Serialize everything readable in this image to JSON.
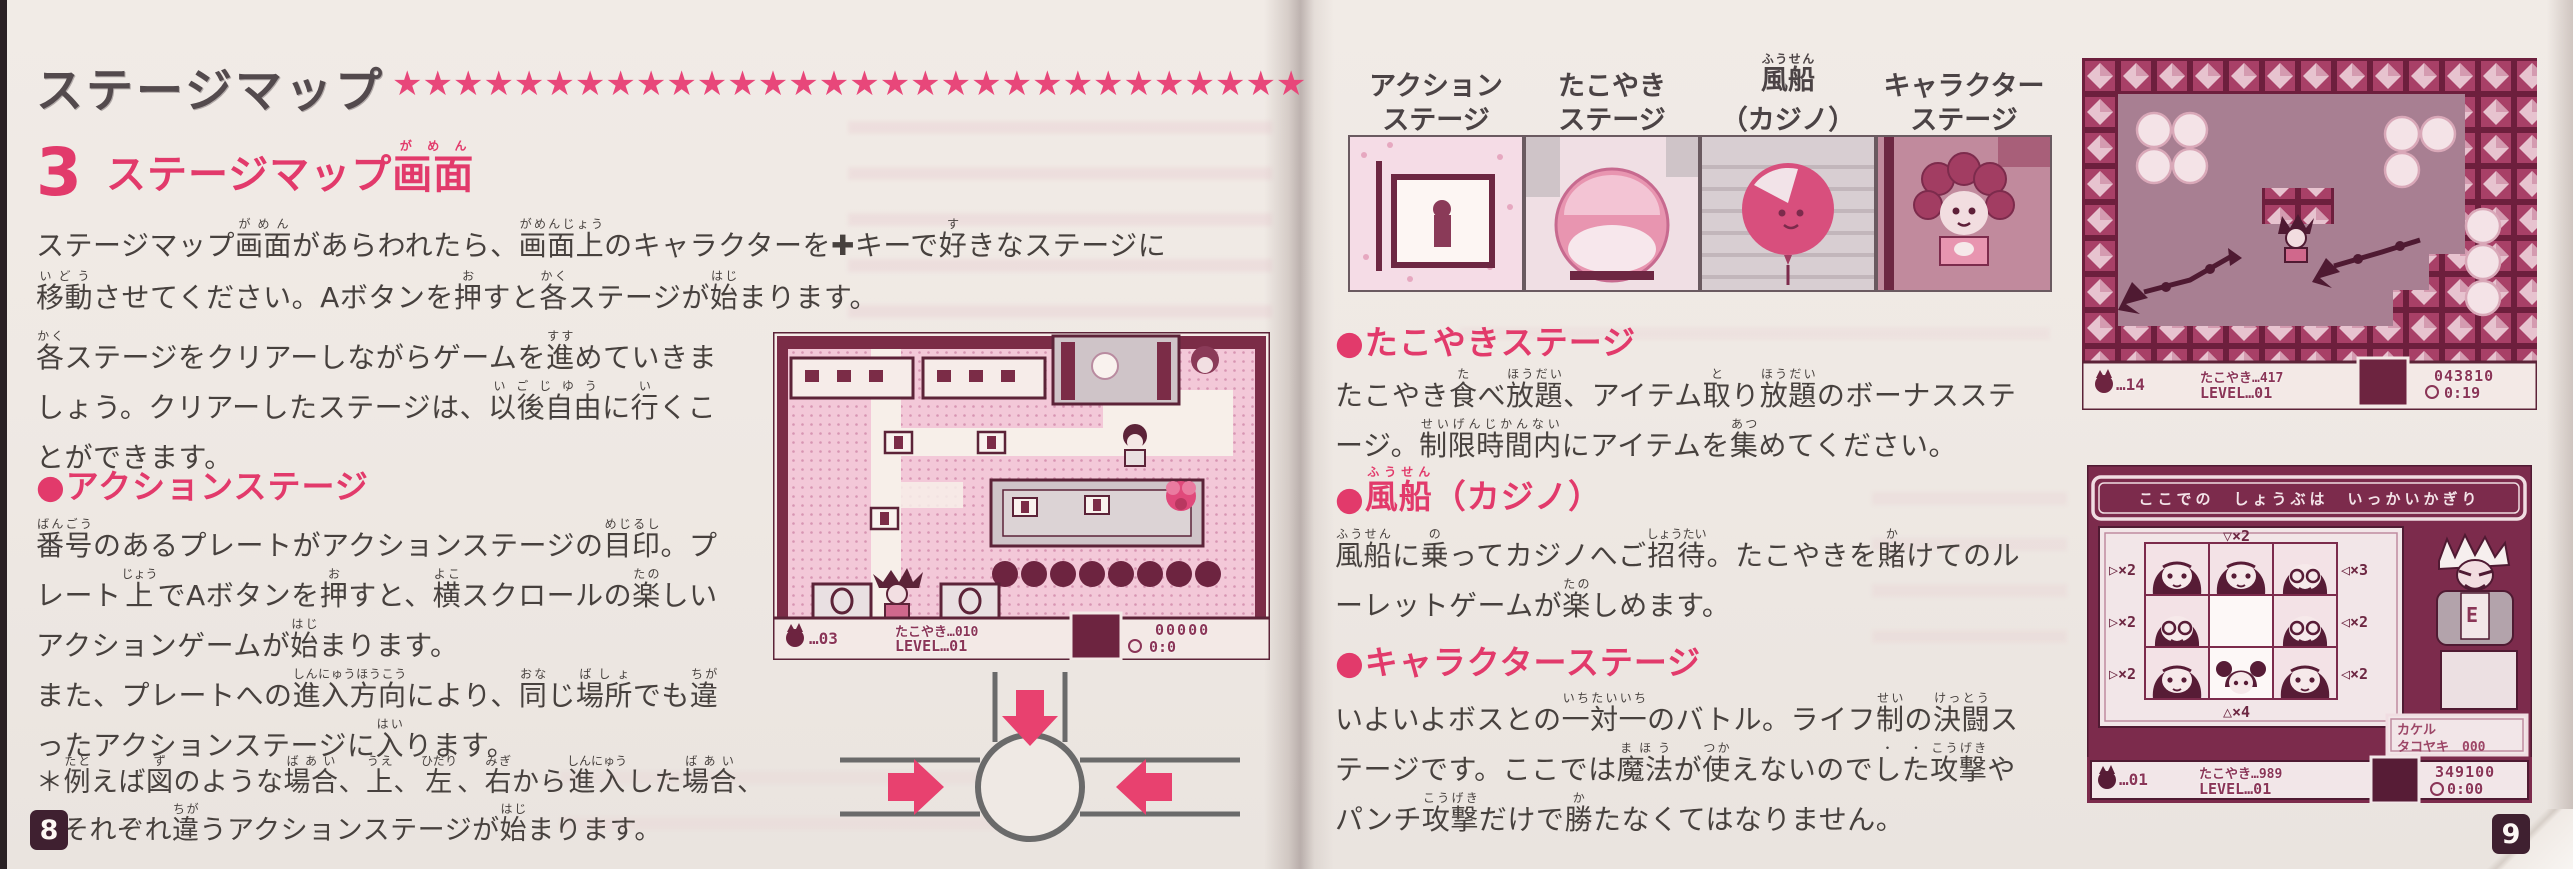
{
  "page_left": {
    "title": "ステージマップ",
    "stars": "★★★★★★★★★★★★★★★★★★★★★★★★★★★★★★",
    "section_number": "3",
    "section_heading": "ステージマップ[画面|がめん]",
    "para1": [
      "ステージマップ[画面|がめん]があらわれたら、[画面上|がめんじょう]のキャラクターを✚キーで[好|す]きなステージに",
      "[移動|いどう]させてください。Aボタンを[押|お]すと[各|かく]ステージが[始|はじ]まります。"
    ],
    "para2": [
      "[各|かく]ステージをクリアーしながらゲームを[進|すす]めていきま",
      "しょう。クリアーしたステージは、[以後自由|いごじゆう]に[行|い]くこ",
      "とができます。"
    ],
    "action_heading": "●アクションステージ",
    "para3": [
      "[番号|ばんごう]のあるプレートがアクションステージの[目印|めじるし]。プ",
      "レート[上|じょう]でAボタンを[押|お]すと、[横|よこ]スクロールの[楽|たの]しい",
      "アクションゲームが[始|はじ]まります。",
      "また、プレートへの[進入方向|しんにゅうほうこう]により、[同|おな]じ[場所|ばしょ]でも[違|ちが]",
      "ったアクションステージに[入|はい]ります。"
    ],
    "footnote": [
      "＊[例|たと]えば[図|ず]のような[場合|ばあい]、[上|うえ]、[左|ひだり]、[右|みぎ]から[進入|しんにゅう]した[場合|ばあい]、",
      "それぞれ[違|ちが]うアクションステージが[始|はじ]まります。"
    ],
    "map_hud": {
      "lives": "…03",
      "takoyaki": "たこやき…010",
      "level": "LEVEL…01",
      "score": "00000",
      "time": "0:0"
    },
    "page_number": "8"
  },
  "page_right": {
    "thumb_labels": [
      [
        "アクション",
        "ステージ"
      ],
      [
        "たこやき",
        "ステージ"
      ],
      [
        "[風船|ふうせん]",
        "（カジノ）"
      ],
      [
        "キャラクター",
        "ステージ"
      ]
    ],
    "takoyaki_heading": "●たこやきステージ",
    "takoyaki_lines": [
      "たこやき[食|た]べ[放題|ほうだい]、アイテム[取|と]り[放題|ほうだい]のボーナスステ",
      "ージ。[制限時間内|せいげんじかんない]にアイテムを[集|あつ]めてください。"
    ],
    "balloon_heading": "●[風船|ふうせん]（カジノ）",
    "balloon_lines": [
      "[風船|ふうせん]に[乗|の]ってカジノへご[招待|しょうたい]。たこやきを[賭|か]けてのル",
      "ーレットゲームが[楽|たの]しめます。"
    ],
    "character_heading": "●キャラクターステージ",
    "character_lines": [
      "いよいよボスとの[一対一|いちたいいち]のバトル。ライフ[制|せい]の[決闘|けっとう]ス",
      "テージです。ここでは[魔法|まほう]が[使|つか]えないので[した|・・][攻撃|こうげき]や",
      "パンチ[攻撃|こうげき]だけで[勝|か]たなくてはなりません。"
    ],
    "block_hud": {
      "lives": "…14",
      "takoyaki": "たこやき…417",
      "level": "LEVEL…01",
      "score": "043810",
      "time": "0:19"
    },
    "casino": {
      "banner": "ここでの　しょうぶは　いっかいかぎり",
      "mult_top": "▽×2",
      "mult_bottom": "△×4",
      "mult_left": [
        "▷×2",
        "▷×2",
        "▷×2"
      ],
      "mult_right": [
        "◁×3",
        "◁×2",
        "◁×2"
      ],
      "bet_line1": "カケル",
      "bet_line2": "タコヤキ　000",
      "dealer_shirt": "E",
      "hud": {
        "lives": "…01",
        "takoyaki": "たこやき…989",
        "level": "LEVEL…01",
        "score": "349100",
        "time": "0:00"
      }
    },
    "page_number": "9"
  },
  "colors": {
    "accent": "#e23a6b",
    "maroon": "#6d2742",
    "text": "#47413e",
    "title": "#534a4d",
    "paper": "#efe9e4"
  }
}
